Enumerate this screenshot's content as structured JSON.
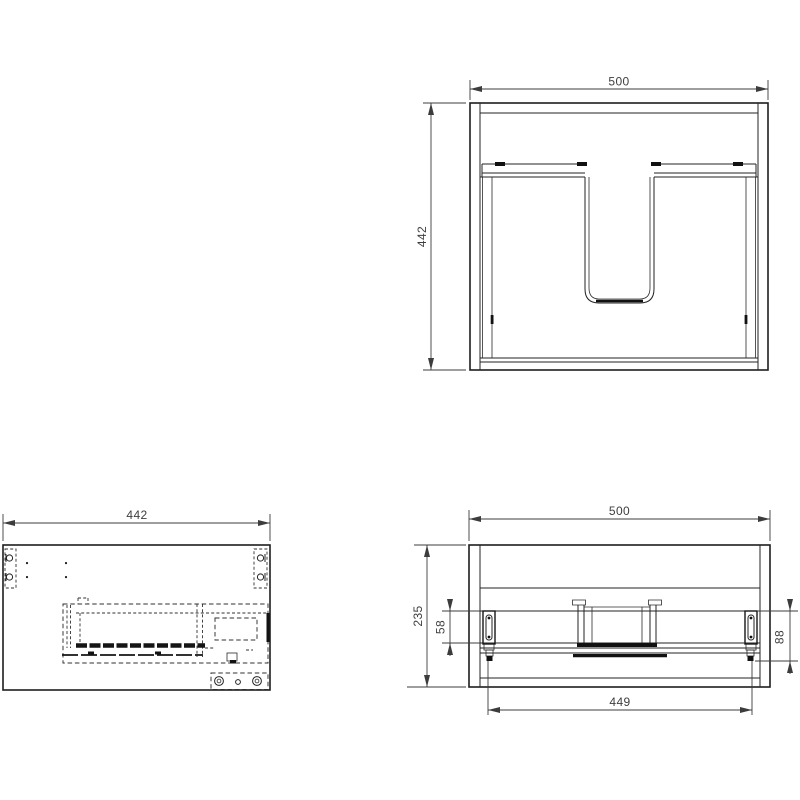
{
  "colors": {
    "background": "#ffffff",
    "line": "#1e1e1e",
    "hidden_line": "#303030",
    "dimension_text": "#3e3e3e"
  },
  "drawing": {
    "views": {
      "plan": {
        "width": "500",
        "depth": "442"
      },
      "side": {
        "depth": "442"
      },
      "front": {
        "width": "500",
        "height": "235",
        "bracket_height": "58",
        "bracket_offset": "88",
        "mount_span": "449"
      }
    }
  }
}
